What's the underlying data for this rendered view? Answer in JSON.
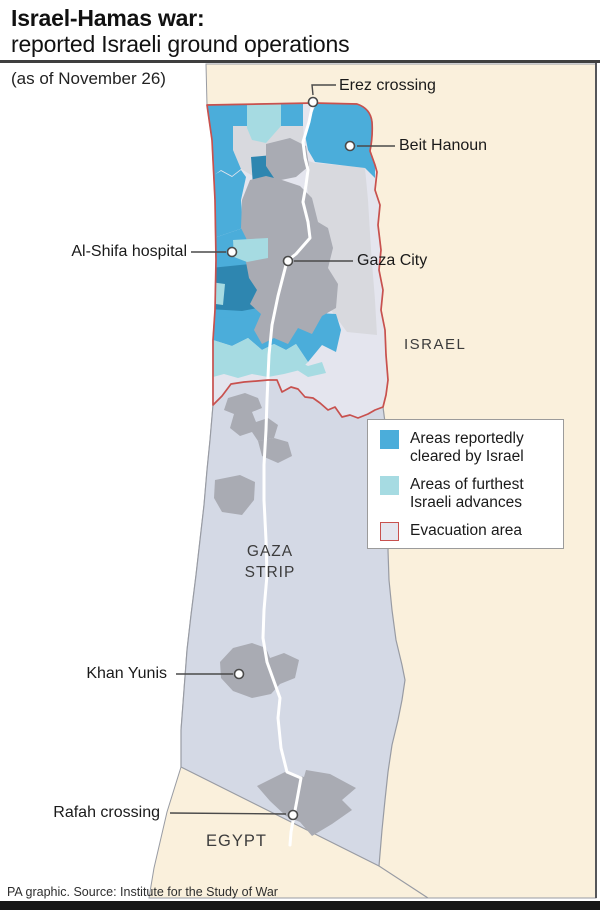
{
  "title": {
    "line1": "Israel-Hamas war:",
    "line2": "reported Israeli ground operations"
  },
  "date_note": "(as of November 26)",
  "map": {
    "labels": {
      "erez": "Erez crossing",
      "beit_hanoun": "Beit Hanoun",
      "al_shifa": "Al-Shifa hospital",
      "gaza_city": "Gaza City",
      "israel": "ISRAEL",
      "gaza_strip_line1": "GAZA",
      "gaza_strip_line2": "STRIP",
      "khan_yunis": "Khan Yunis",
      "rafah": "Rafah crossing",
      "egypt": "EGYPT"
    }
  },
  "legend": {
    "items": [
      {
        "line1": "Areas reportedly",
        "line2": "cleared by Israel",
        "color": "#4badda"
      },
      {
        "line1": "Areas of furthest",
        "line2": "Israeli advances",
        "color": "#a6dbe2"
      },
      {
        "line1": "Evacuation area",
        "line2": "",
        "color": "#e4e5ee",
        "border_color": "#c8514e"
      }
    ]
  },
  "colors": {
    "land": "#faf0dc",
    "sea": "#ffffff",
    "strip_south": "#d4d9e5",
    "evacuation_fill": "#e4e5ee",
    "cleared": "#4badda",
    "cleared_dark": "#2e86b0",
    "advances": "#a6dbe2",
    "urban": "#a9abb3",
    "urban_light": "#d8d9de",
    "evacuation_border": "#c8514e",
    "road": "#ffffff",
    "border_line": "#989ba3",
    "marker_line": "#4a4a4a",
    "bar": "#161616"
  },
  "footer": "PA graphic. Source: Institute for the Study of War"
}
